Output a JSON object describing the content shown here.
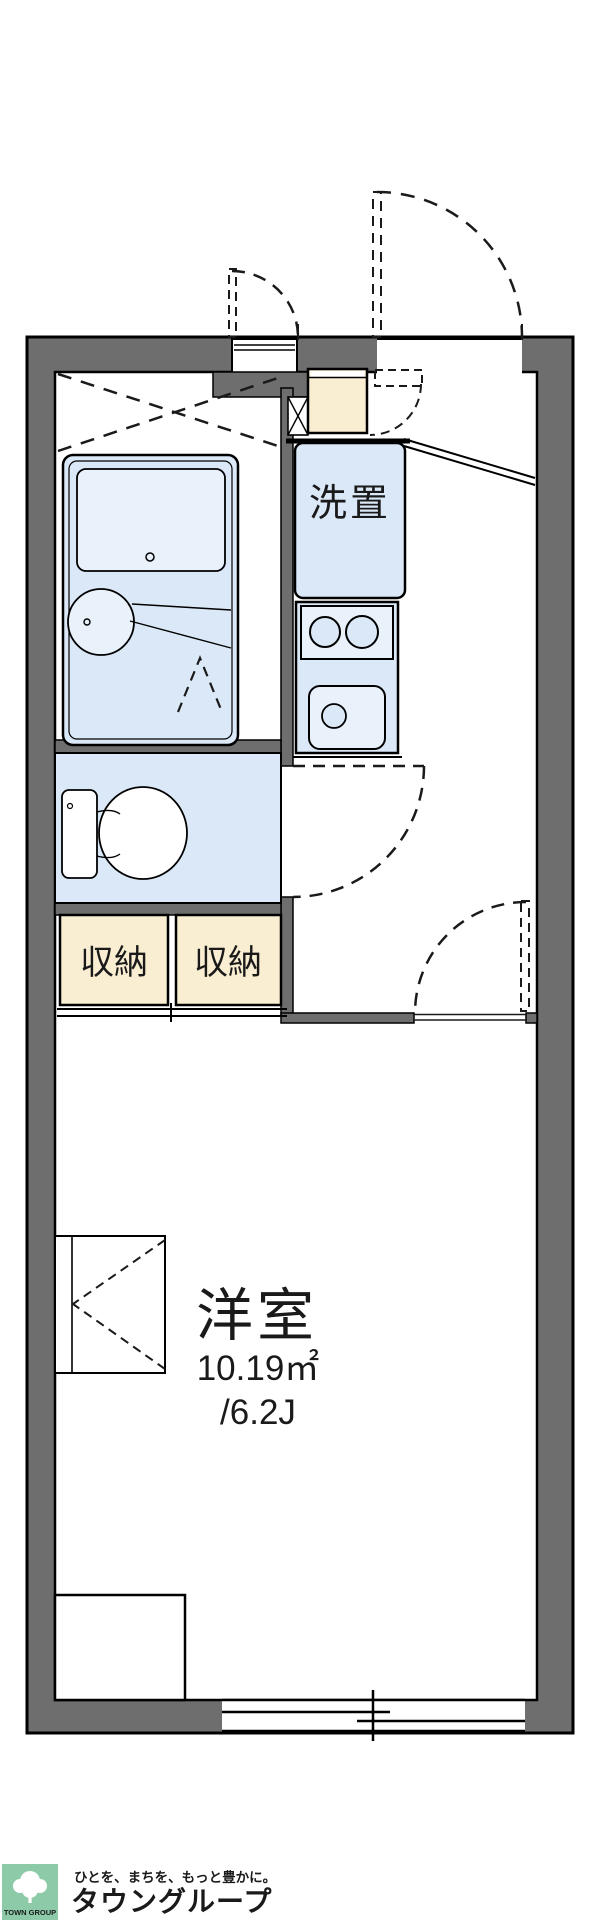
{
  "floorplan": {
    "labels": {
      "washer_space": "洗置",
      "storage_left": "収納",
      "storage_right": "収納",
      "main_room": "洋室",
      "main_room_area_sqm": "10.19㎡",
      "main_room_area_tatami": "/6.2J"
    },
    "colors": {
      "wall_gray": "#6e6e6e",
      "room_blue": "#dbe8f7",
      "fixture_blue": "#e9f1fb",
      "storage_cream": "#f9edd2",
      "line_black": "#1a1a1a",
      "white": "#ffffff"
    }
  },
  "footer": {
    "logo_square_label": "TOWN GROUP",
    "tagline": "ひとを、まちを、もっと豊かに。",
    "brand": "タウングループ",
    "colors": {
      "logo_green": "#8ccaa8",
      "brand_green": "#6fbf95",
      "tagline_gray": "#98a8a1"
    }
  }
}
